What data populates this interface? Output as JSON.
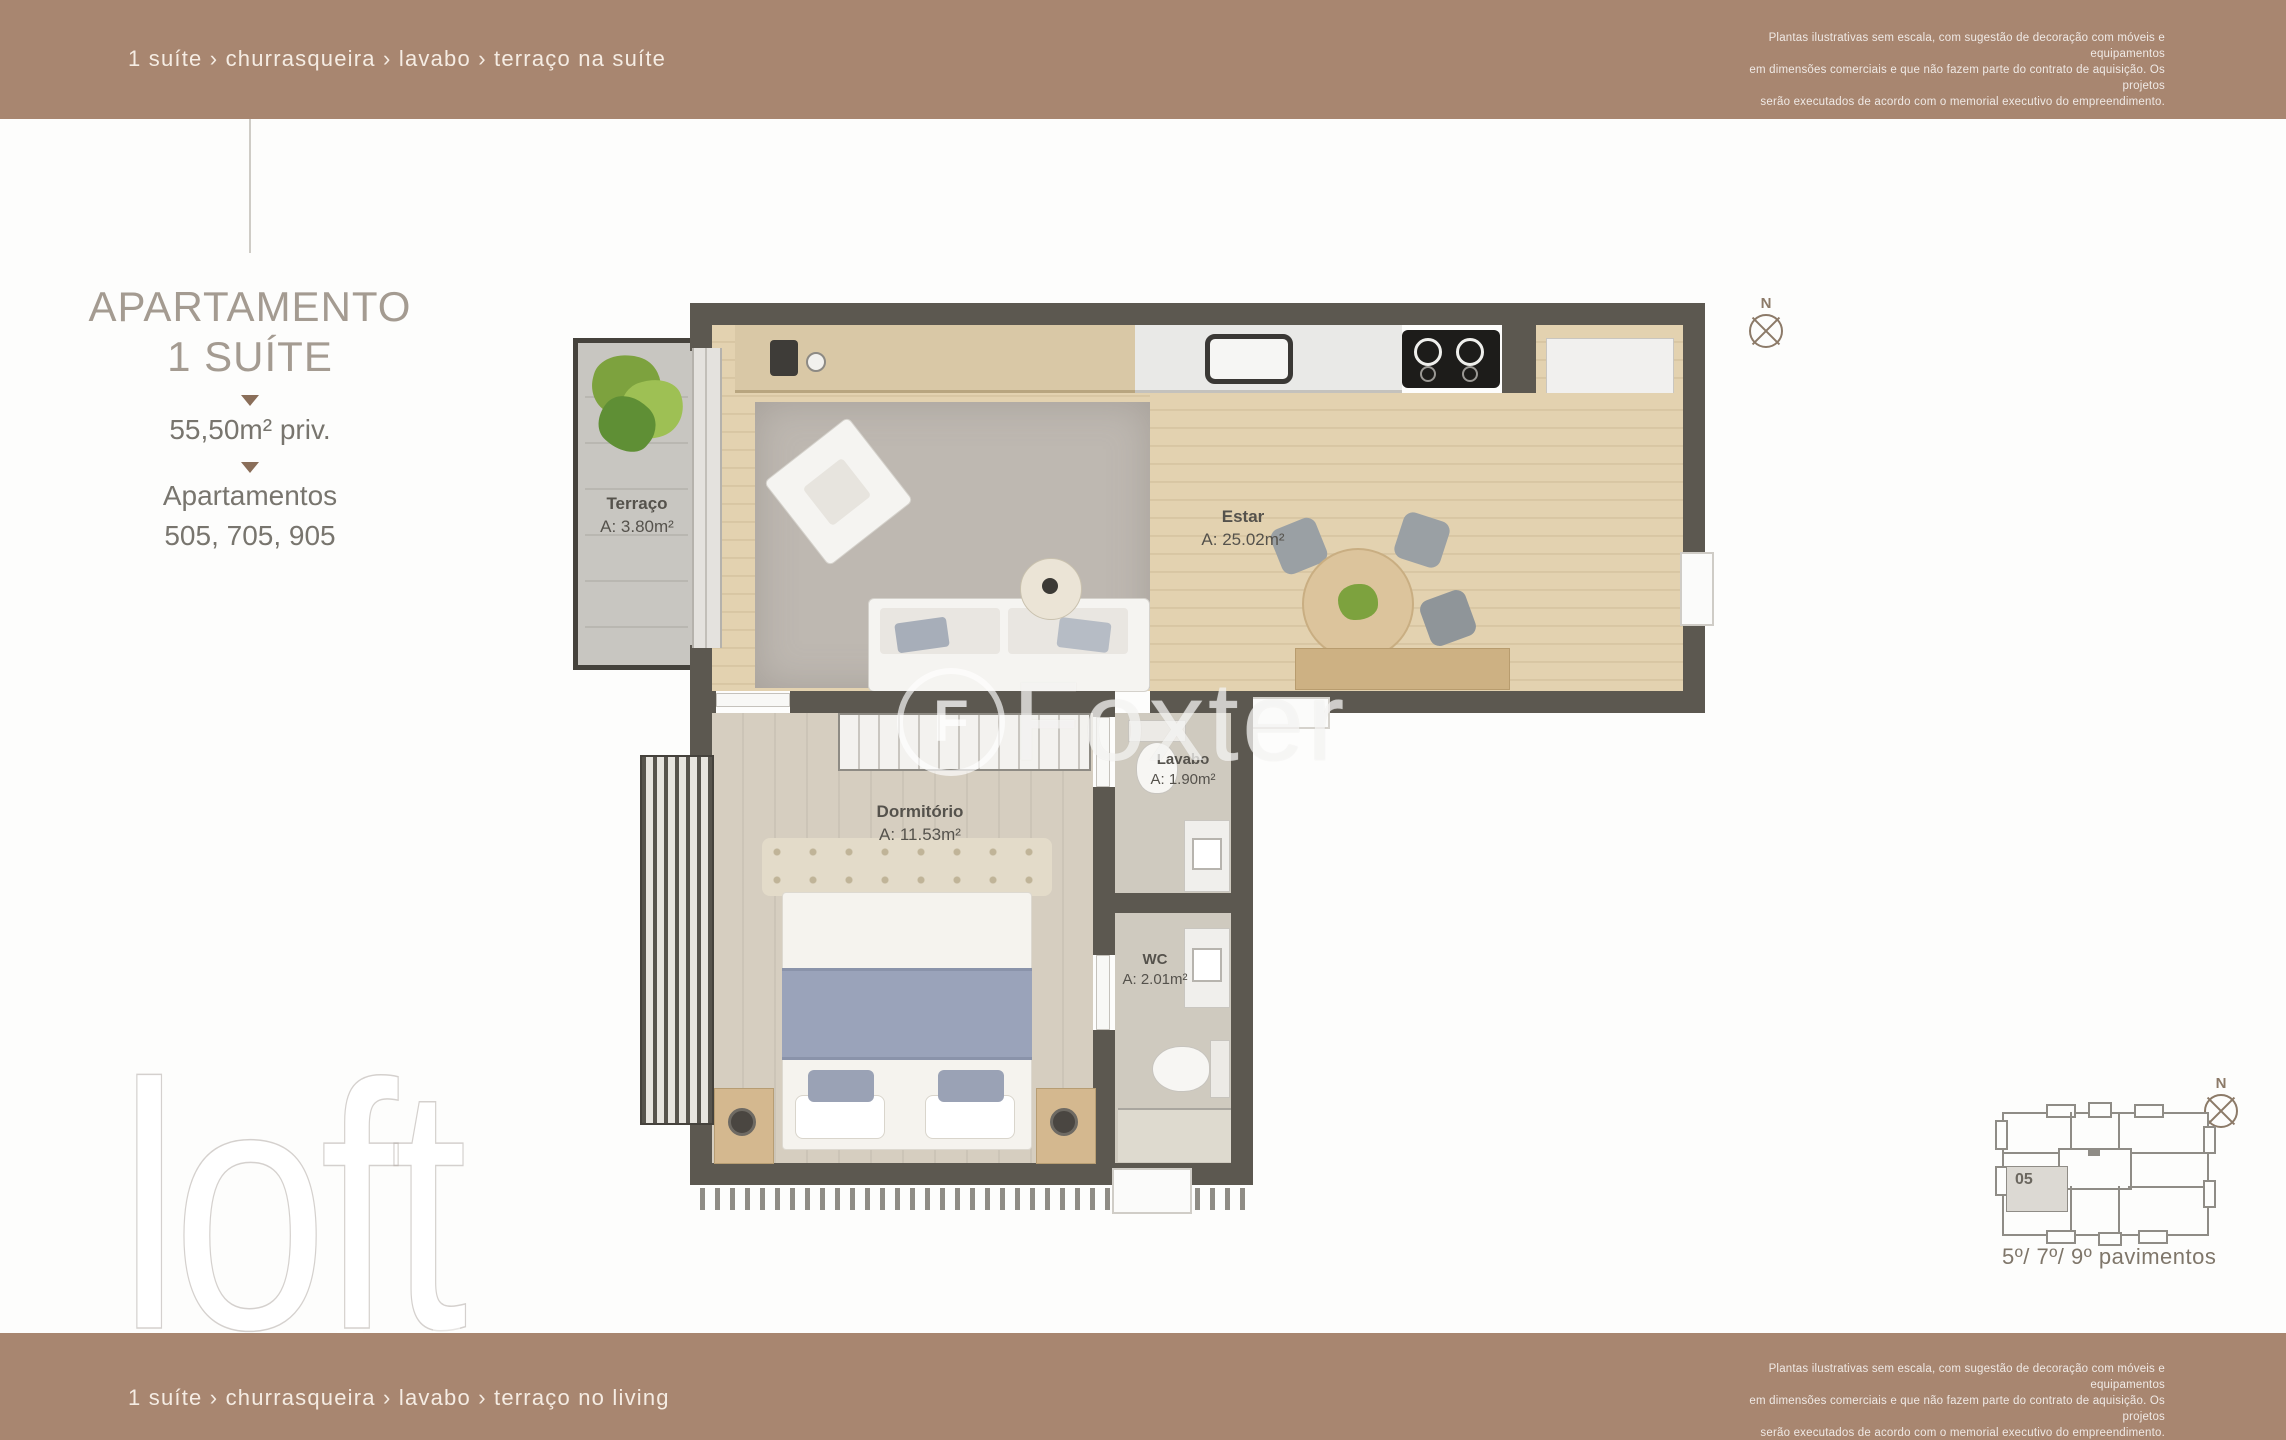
{
  "header": {
    "features": "1 suíte › churrasqueira › lavabo › terraço na suíte",
    "disclaimer_line1": "Plantas ilustrativas sem escala, com sugestão de decoração com móveis e equipamentos",
    "disclaimer_line2": "em dimensões comerciais e que não fazem parte do contrato de aquisição. Os projetos",
    "disclaimer_line3": "serão executados de acordo com o memorial executivo do empreendimento."
  },
  "sidebar": {
    "title_line1": "APARTAMENTO",
    "title_line2": "1 SUÍTE",
    "private_area": "55,50m² priv.",
    "apartments_label": "Apartamentos",
    "apartment_numbers": "505, 705, 905"
  },
  "plan": {
    "compass_letter": "N",
    "rooms": [
      {
        "name": "Terraço",
        "area": "A: 3.80m²"
      },
      {
        "name": "Estar",
        "area": "A: 25.02m²"
      },
      {
        "name": "Dormitório",
        "area": "A: 11.53m²"
      },
      {
        "name": "Lavabo",
        "area": "A: 1.90m²"
      },
      {
        "name": "WC",
        "area": "A: 2.01m²"
      }
    ]
  },
  "watermarks": {
    "foxter_initial": "F",
    "foxter": "Foxter",
    "loft": "loft"
  },
  "keyplan": {
    "unit_number": "05",
    "caption": "5º/ 7º/ 9º pavimentos",
    "compass_letter": "N"
  },
  "footer": {
    "features": "1 suíte › churrasqueira › lavabo › terraço no living"
  },
  "colors": {
    "bar_brown": "#a88670",
    "wall": "#5c5850",
    "wood_floor": "#e0cfae",
    "title_gray": "#a49b91",
    "accent_triangle": "#8a6e59",
    "label_text": "#55524c"
  }
}
